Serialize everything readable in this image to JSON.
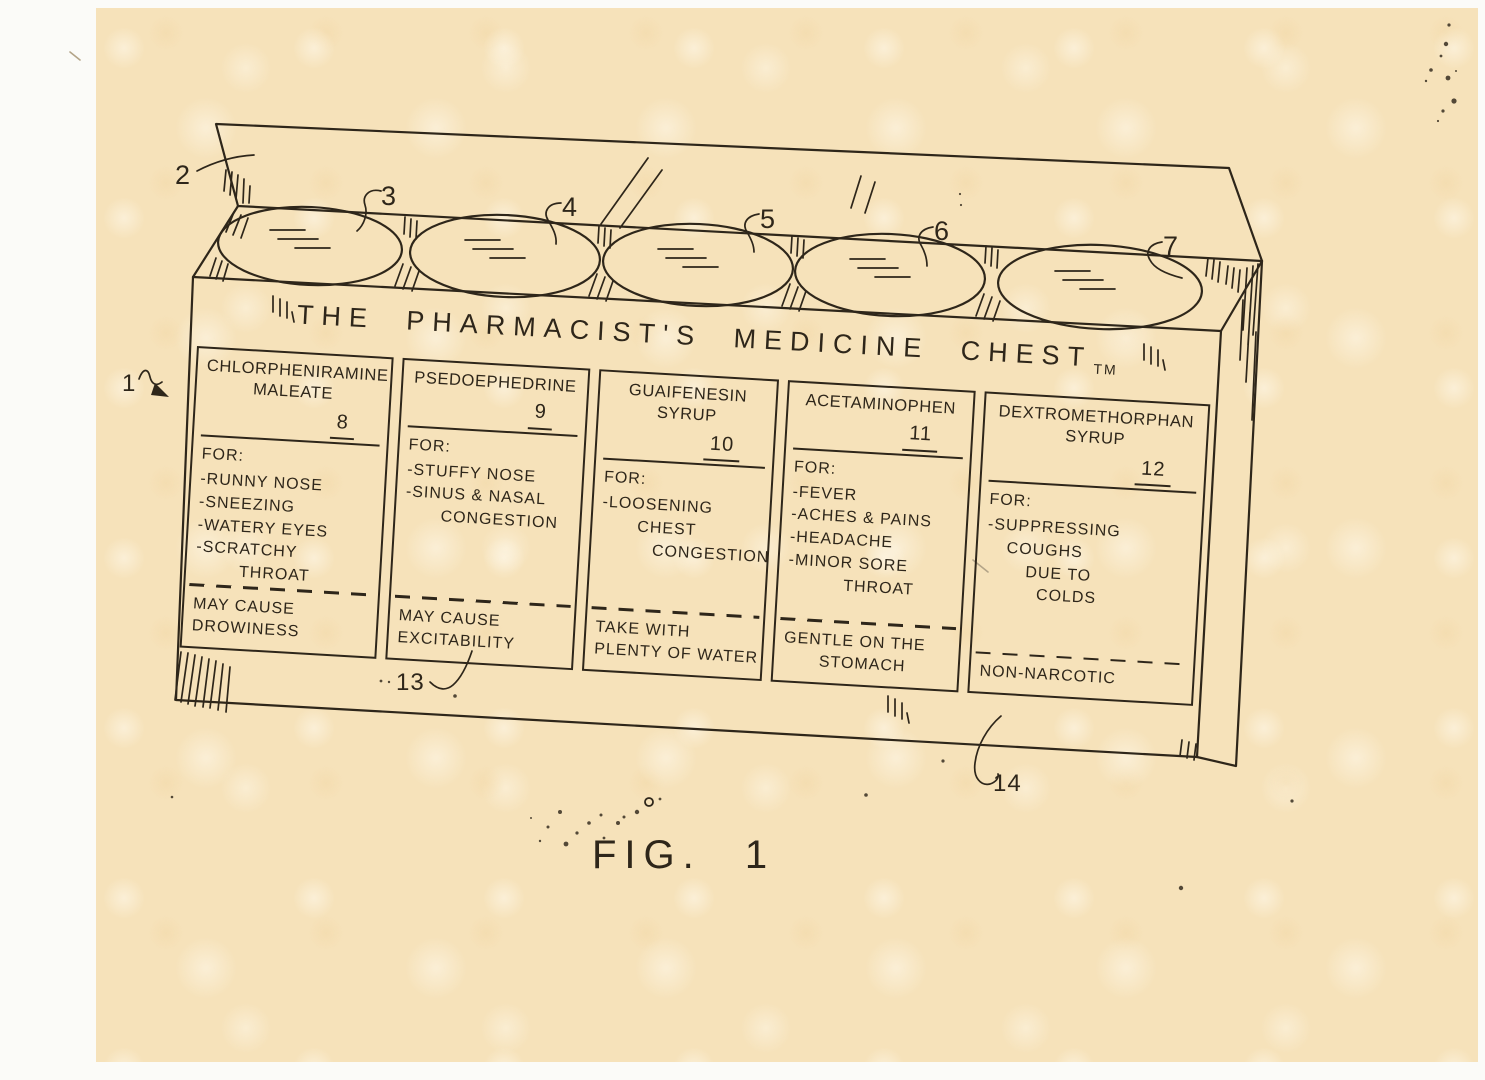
{
  "palette": {
    "page": "#fbfbf8",
    "paper": "#f6e2ba",
    "ink": "#2e261a",
    "pencil": "#b3a488"
  },
  "figure": {
    "caption": "FIG. 1"
  },
  "chest": {
    "title": "THE PHARMACIST'S MEDICINE CHEST",
    "trademark": "TM"
  },
  "ref": {
    "r1": "1",
    "r2": "2",
    "r3": "3",
    "r4": "4",
    "r5": "5",
    "r6": "6",
    "r7": "7",
    "r13": "13",
    "r14": "14"
  },
  "panels": [
    {
      "number": "8",
      "name1": "CHLORPHENIRAMINE",
      "name2": "MALEATE",
      "for_label": "FOR:",
      "items": [
        "-RUNNY NOSE",
        "-SNEEZING",
        "-WATERY EYES",
        "-SCRATCHY",
        "THROAT"
      ],
      "note1": "MAY CAUSE",
      "note2": "DROWINESS"
    },
    {
      "number": "9",
      "name1": "PSEDOEPHEDRINE",
      "for_label": "FOR:",
      "items": [
        "-STUFFY NOSE",
        "-SINUS & NASAL",
        "CONGESTION"
      ],
      "note1": "MAY CAUSE",
      "note2": "EXCITABILITY"
    },
    {
      "number": "10",
      "name1": "GUAIFENESIN",
      "name2": "SYRUP",
      "for_label": "FOR:",
      "items": [
        "-LOOSENING",
        "CHEST",
        "CONGESTION"
      ],
      "note1": "TAKE WITH",
      "note2": "PLENTY OF WATER"
    },
    {
      "number": "11",
      "name1": "ACETAMINOPHEN",
      "for_label": "FOR:",
      "items": [
        "-FEVER",
        "-ACHES & PAINS",
        "-HEADACHE",
        "-MINOR SORE",
        "THROAT"
      ],
      "note1": "GENTLE ON THE",
      "note2": "STOMACH"
    },
    {
      "number": "12",
      "name1": "DEXTROMETHORPHAN",
      "name2": "SYRUP",
      "for_label": "FOR:",
      "items": [
        "-SUPPRESSING",
        "COUGHS",
        "DUE TO",
        "COLDS"
      ],
      "note1": "NON-NARCOTIC"
    }
  ]
}
